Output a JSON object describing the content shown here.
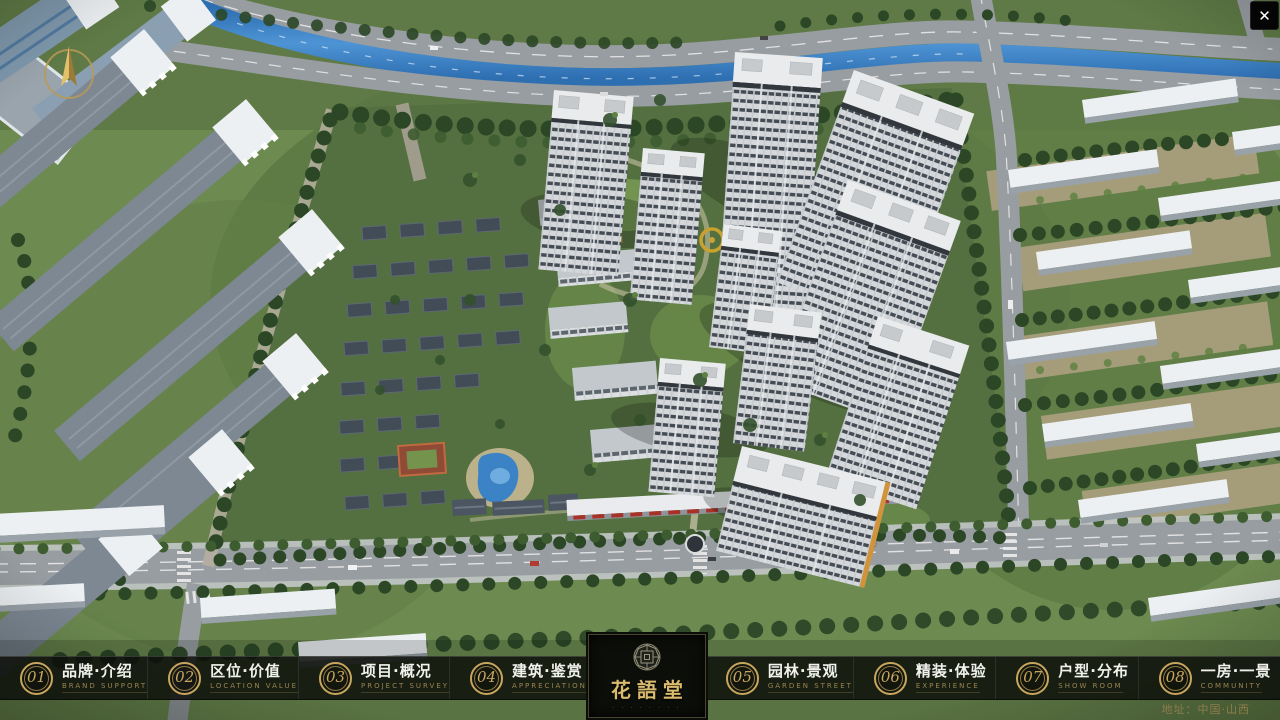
{
  "theme": {
    "gold": "#c9a65e",
    "gold-dim": "#9a8450",
    "bar-bg": "rgba(12,14,10,0.84)",
    "panel-bg": "#0c0e09",
    "text-white": "#f1f1ec"
  },
  "window": {
    "close_glyph": "✕"
  },
  "nav": {
    "left_items": [
      {
        "num": "01",
        "zh": "品牌·介绍",
        "en": "BRAND SUPPORT"
      },
      {
        "num": "02",
        "zh": "区位·价值",
        "en": "LOCATION VALUE"
      },
      {
        "num": "03",
        "zh": "项目·概况",
        "en": "PROJECT SURVEY"
      },
      {
        "num": "04",
        "zh": "建筑·鉴赏",
        "en": "APPRECIATION"
      }
    ],
    "right_items": [
      {
        "num": "05",
        "zh": "园林·景观",
        "en": "GARDEN STREET"
      },
      {
        "num": "06",
        "zh": "精装·体验",
        "en": "EXPERIENCE"
      },
      {
        "num": "07",
        "zh": "户型·分布",
        "en": "SHOW ROOM"
      },
      {
        "num": "08",
        "zh": "一房·一景",
        "en": "COMMUNITY"
      }
    ]
  },
  "logo": {
    "name": "花語堂",
    "tagline": "· · · · · · · ·"
  },
  "footer": {
    "address": "地址：中国·山西"
  }
}
